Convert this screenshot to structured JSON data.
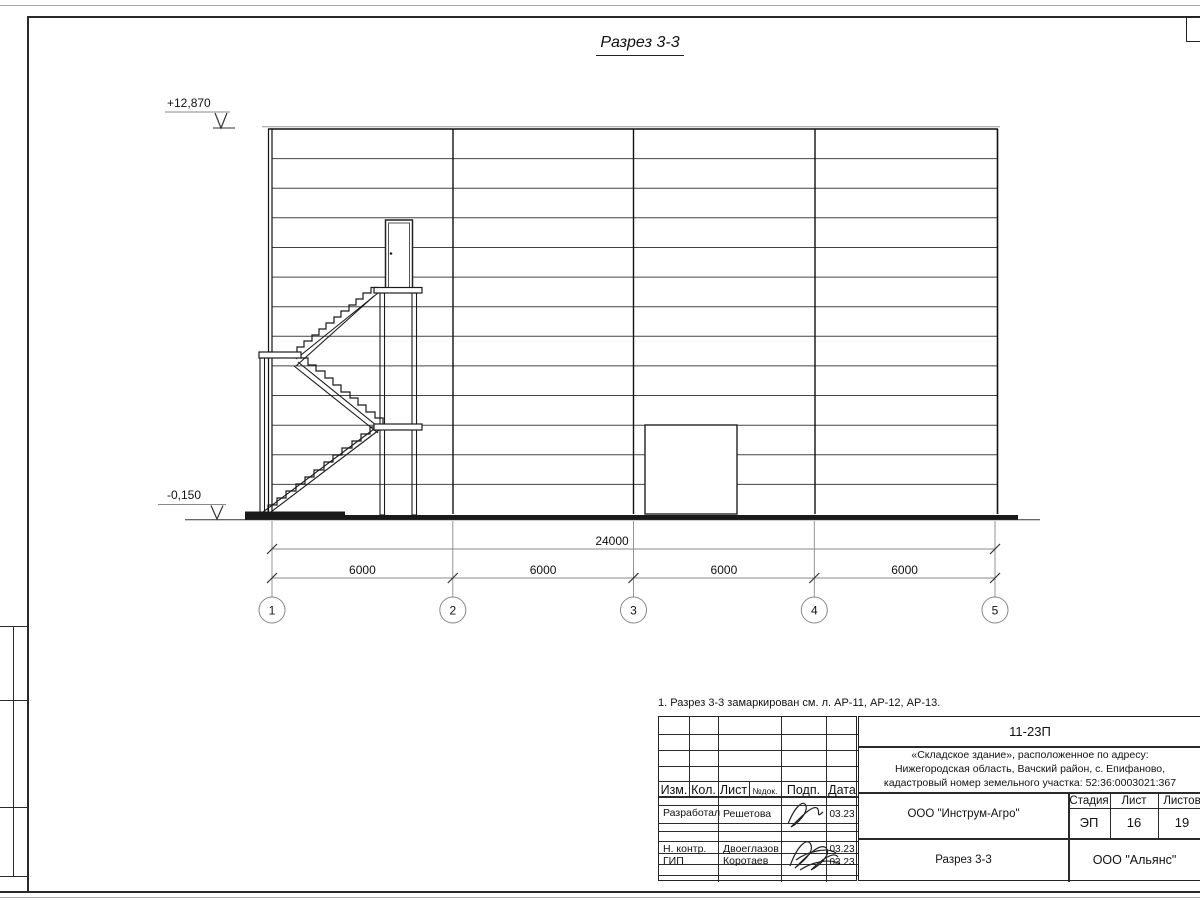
{
  "title": "Разрез 3-3",
  "note": "1. Разрез 3-3 замаркирован см. л. АР-11, АР-12, АР-13.",
  "drawing": {
    "elevation_top": "+12,870",
    "elevation_bottom": "-0,150",
    "dim_total": "24000",
    "dim_segments": [
      "6000",
      "6000",
      "6000",
      "6000"
    ],
    "axes": [
      "1",
      "2",
      "3",
      "4",
      "5"
    ]
  },
  "titleblock": {
    "doc_code": "11-23П",
    "object_line1": "«Складское здание», расположенное по адресу:",
    "object_line2": "Нижегородская область, Вачский район, с. Епифаново,",
    "object_line3": "кадастровый номер земельного участка: 52:36:0003021:367",
    "header": {
      "izm": "Изм.",
      "kol": "Кол.",
      "list": "Лист",
      "ndok": "№док.",
      "podp": "Подп.",
      "data": "Дата"
    },
    "rows": [
      {
        "role": "Разработал",
        "name": "Решетова",
        "date": "03.23"
      },
      {
        "role": "Н. контр.",
        "name": "Двоеглазов",
        "date": "03.23"
      },
      {
        "role": "ГИП",
        "name": "Коротаев",
        "date": "03.23"
      }
    ],
    "org": "ООО \"Инструм-Агро\"",
    "stage_label": "Стадия",
    "sheet_label": "Лист",
    "sheets_label": "Листов",
    "stage": "ЭП",
    "sheet": "16",
    "sheets": "19",
    "section_name": "Разрез 3-3",
    "contractor": "ООО \"Альянс\""
  }
}
